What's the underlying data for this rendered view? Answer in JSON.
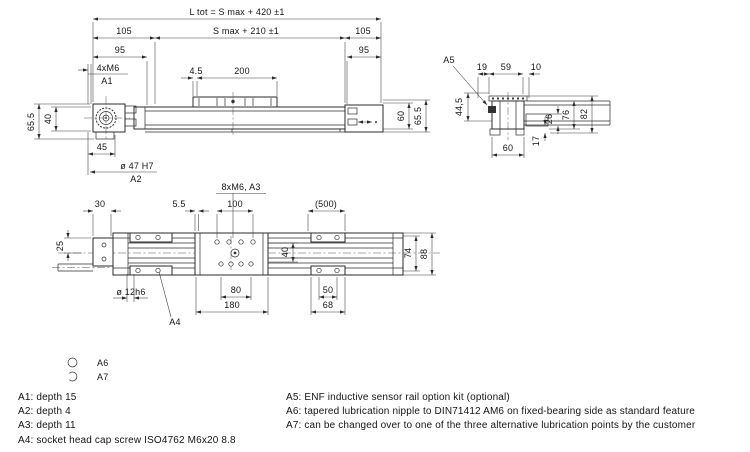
{
  "side_view": {
    "l_tot": "L tot = S max + 420 ±1",
    "s_max": "S max + 210 ±1",
    "d105_left": "105",
    "d105_right": "105",
    "d95_left": "95",
    "d95_right": "95",
    "m6": "4xM6",
    "a1": "A1",
    "d4_5": "4.5",
    "d200": "200",
    "d65_5_left": "65.5",
    "d40": "40",
    "d45": "45",
    "d47": "ø 47 H7",
    "a2": "A2",
    "d60": "60",
    "d65_5_right": "65.5"
  },
  "section_view": {
    "a5": "A5",
    "d19": "19",
    "d59": "59",
    "d10": "10",
    "d44_5": "44,5",
    "d76": "76",
    "d82": "82",
    "d26": "26",
    "d17": "17",
    "d60": "60"
  },
  "top_view": {
    "m6": "8xM6, A3",
    "d5_5": "5.5",
    "d100": "100",
    "d500": "(500)",
    "d30": "30",
    "d25": "25",
    "d40": "40",
    "d74": "74",
    "d88": "88",
    "d12": "ø 12h6",
    "a4": "A4",
    "d80": "80",
    "d180": "180",
    "d50": "50",
    "d68": "68"
  },
  "legend": {
    "a6": "A6",
    "a7": "A7"
  },
  "notes_left": [
    "A1: depth 15",
    "A2: depth 4",
    "A3: depth 11",
    "A4: socket head cap screw ISO4762 M6x20 8.8"
  ],
  "notes_right": [
    "A5: ENF inductive sensor rail option kit (optional)",
    "A6: tapered lubrication nipple to DIN71412 AM6 on fixed-bearing side as standard feature",
    "A7: can be changed over to one of the three alternative lubrication points by the customer"
  ]
}
